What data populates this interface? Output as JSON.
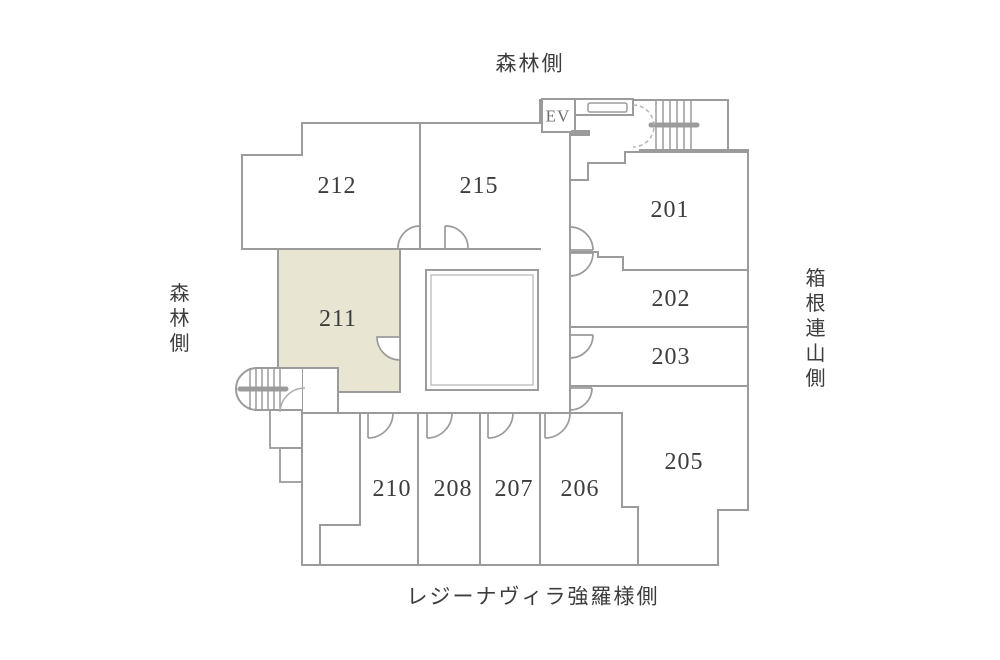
{
  "plan": {
    "side_labels": {
      "top": "森林側",
      "left": "森林側",
      "right": "箱根連山側",
      "bottom": "レジーナヴィラ強羅様側"
    },
    "elevator_label": "EV",
    "highlighted_room": "211",
    "rooms": [
      {
        "number": "201"
      },
      {
        "number": "202"
      },
      {
        "number": "203"
      },
      {
        "number": "205"
      },
      {
        "number": "206"
      },
      {
        "number": "207"
      },
      {
        "number": "208"
      },
      {
        "number": "210"
      },
      {
        "number": "211",
        "highlighted": true
      },
      {
        "number": "212"
      },
      {
        "number": "215"
      }
    ],
    "colors": {
      "wall": "#9b9b9b",
      "highlight_fill": "#e8e6d2",
      "text": "#3d3d3d",
      "background": "#ffffff"
    }
  }
}
